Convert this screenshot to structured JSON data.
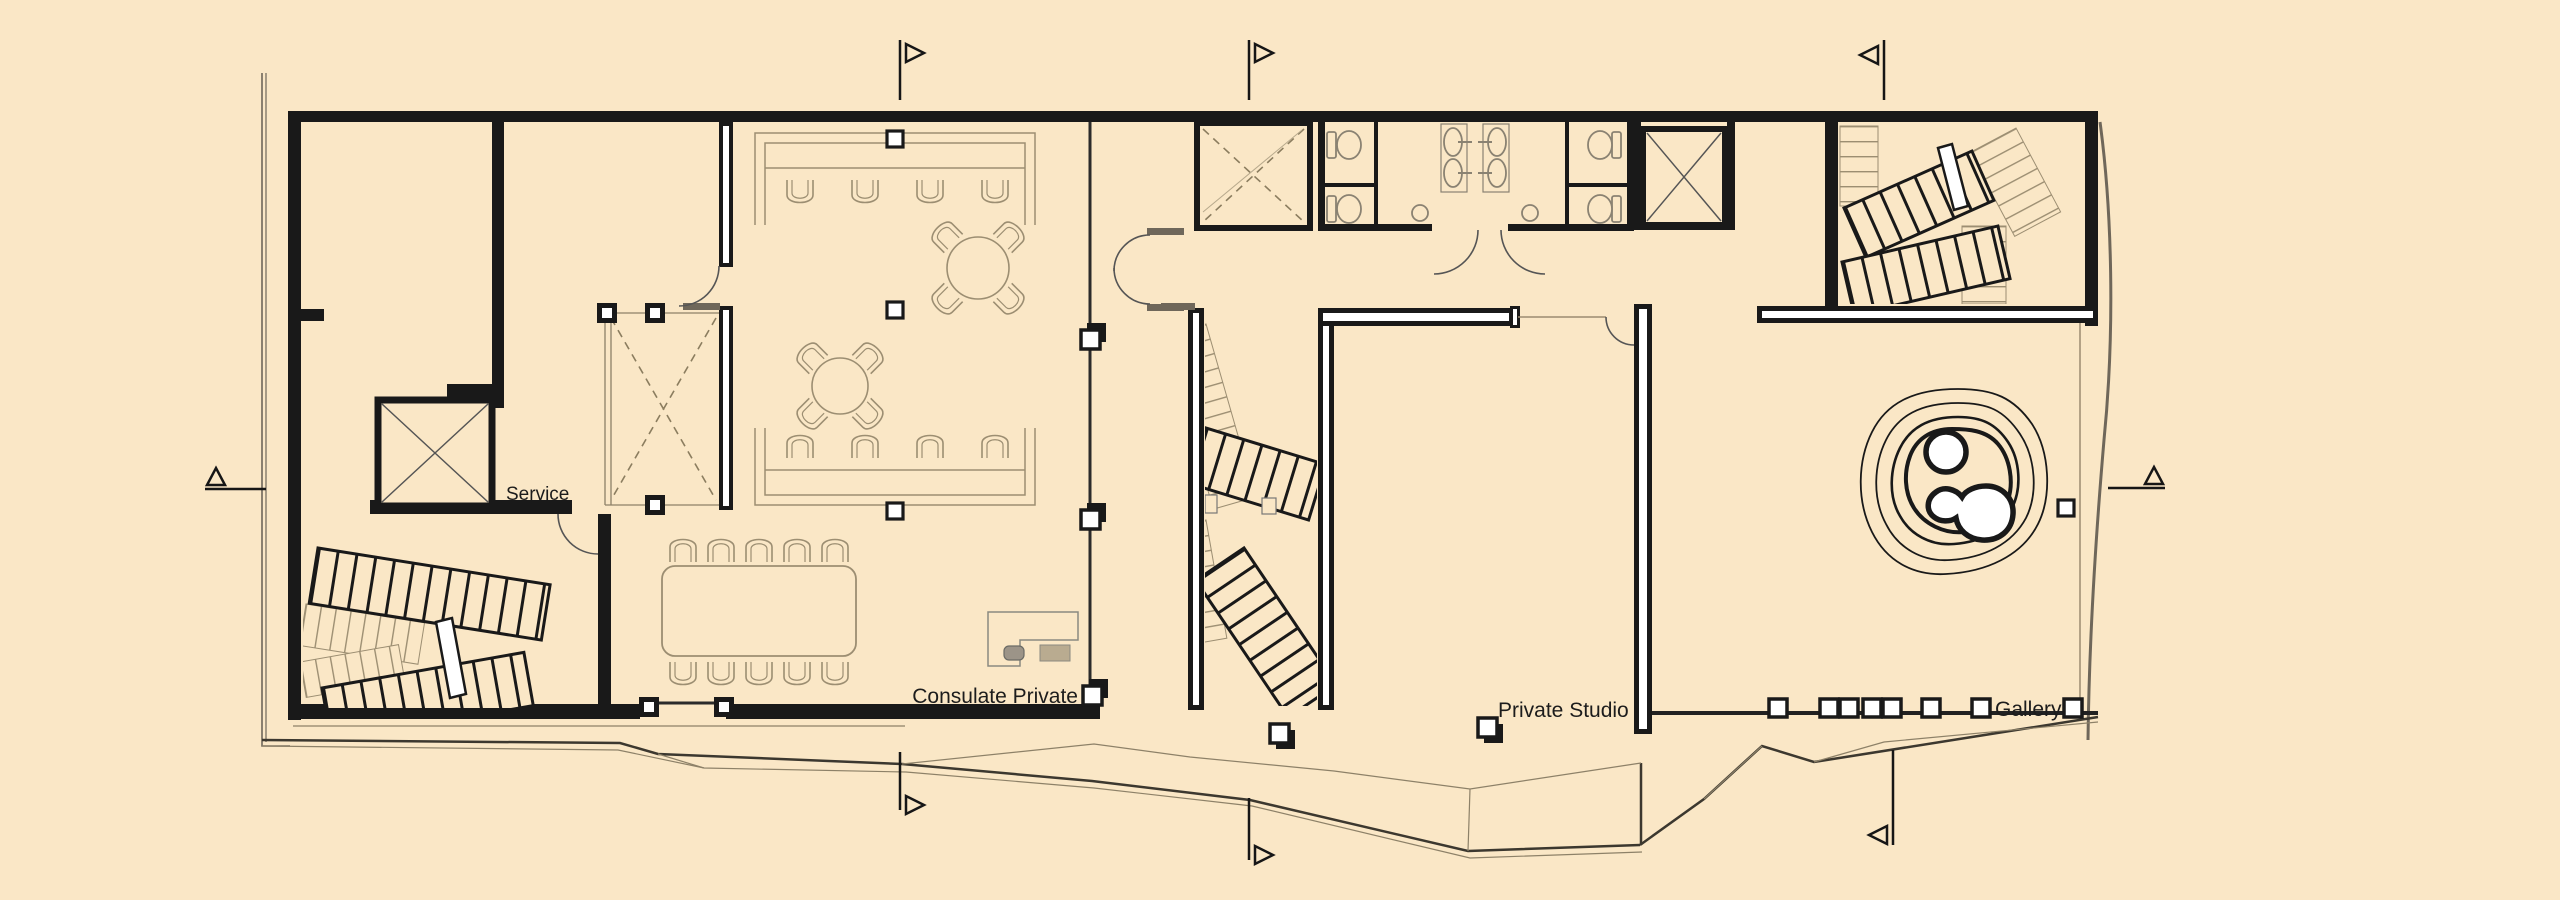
{
  "canvas": {
    "width": 2560,
    "height": 900,
    "background": "#fae7c6"
  },
  "colors": {
    "ink": "#191919",
    "furniture": "#9c8e72",
    "site_line": "#6f675a",
    "terrain_dark": "#3c382f",
    "terrain_light": "#8d8168",
    "dashed_brace": "#8b7d5f",
    "fixture": "#8a8272",
    "white": "#ffffff"
  },
  "labels": {
    "service": "Service",
    "consulate_private": "Consulate Private",
    "private_studio": "Private Studio",
    "gallery": "Gallery"
  },
  "plan": {
    "type": "architectural-floor-plan",
    "rooms": [
      "Service",
      "Consulate Private",
      "Private Studio",
      "Gallery"
    ],
    "features": [
      "two elevator shafts",
      "three staircases",
      "two restroom blocks",
      "skylight voids with dashed bracing",
      "service counters with chairs",
      "two round tables",
      "conference table with 10 chairs",
      "reception desk",
      "contour water feature",
      "section cut markers",
      "terrain deck edge"
    ]
  }
}
